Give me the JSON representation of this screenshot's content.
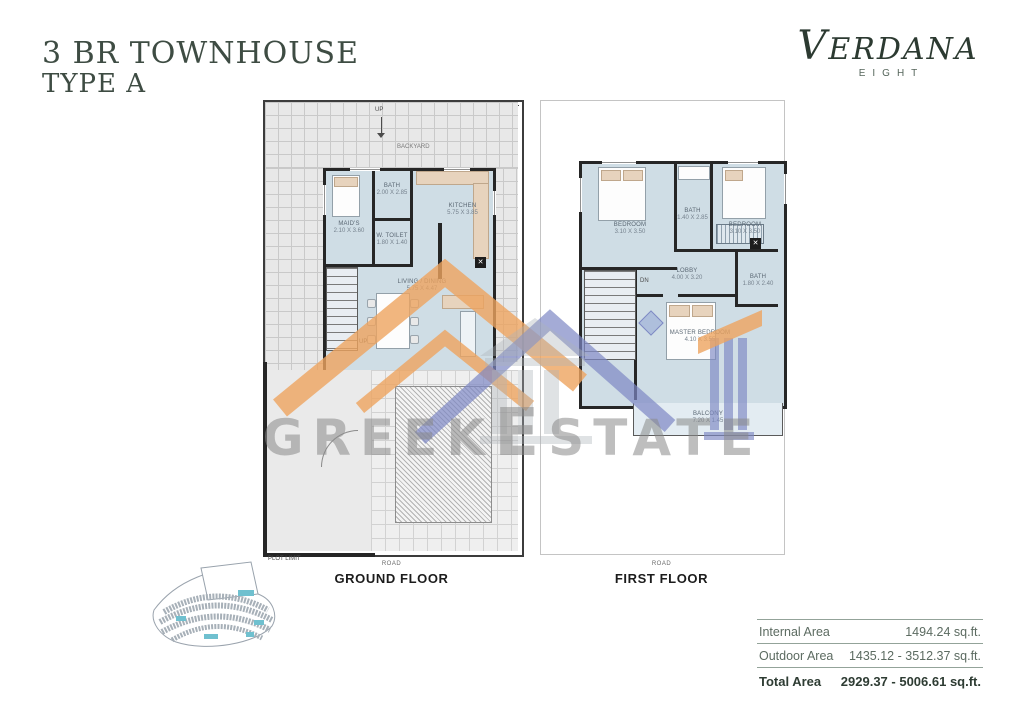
{
  "page": {
    "title_line1": "3 BR TOWNHOUSE",
    "title_line2": "TYPE A"
  },
  "logo": {
    "brand": "VERDANA",
    "sub": "EIGHT"
  },
  "watermark": {
    "part1": "GREEK",
    "part2": "ESTATE"
  },
  "plans": {
    "ground": {
      "caption": "GROUND FLOOR",
      "road_label": "ROAD",
      "plot_limit_label": "PLOT LIMIT",
      "up_label": "UP",
      "backyard_label": "BACKYARD",
      "stairs_label": "UP",
      "rooms": [
        {
          "name": "MAID'S",
          "dims": "2.10 X 3.60"
        },
        {
          "name": "BATH",
          "dims": "2.00 X 2.85"
        },
        {
          "name": "W. TOILET",
          "dims": "1.80 X 1.40"
        },
        {
          "name": "KITCHEN",
          "dims": "5.75 X 3.85"
        },
        {
          "name": "LIVING / DINING",
          "dims": "5.75 X 4.47"
        }
      ]
    },
    "first": {
      "caption": "FIRST FLOOR",
      "road_label": "ROAD",
      "stairs_label": "DN",
      "rooms": [
        {
          "name": "BEDROOM",
          "dims": "3.10 X 3.50"
        },
        {
          "name": "BATH",
          "dims": "1.40 X 2.85"
        },
        {
          "name": "BEDROOM",
          "dims": "3.10 X 3.50"
        },
        {
          "name": "LOBBY",
          "dims": "4.00 X 3.20"
        },
        {
          "name": "MASTER BEDROOM",
          "dims": "4.10 X 3.55"
        },
        {
          "name": "BATH",
          "dims": "1.80 X 2.40"
        },
        {
          "name": "BALCONY",
          "dims": "7.20 X 1.45"
        }
      ]
    }
  },
  "areas": {
    "rows": [
      {
        "label": "Internal Area",
        "value": "1494.24 sq.ft."
      },
      {
        "label": "Outdoor Area",
        "value": "1435.12 - 3512.37 sq.ft."
      },
      {
        "label": "Total Area",
        "value": "2929.37 - 5006.61 sq.ft."
      }
    ]
  },
  "colors": {
    "brand_green": "#2c3a31",
    "floor_fill": "#cfdde5",
    "watermark_orange": "#eda45f",
    "watermark_blue": "#7d88c4",
    "watermark_gray": "#8a8a8a",
    "highlight_teal": "#6fc0cf"
  }
}
